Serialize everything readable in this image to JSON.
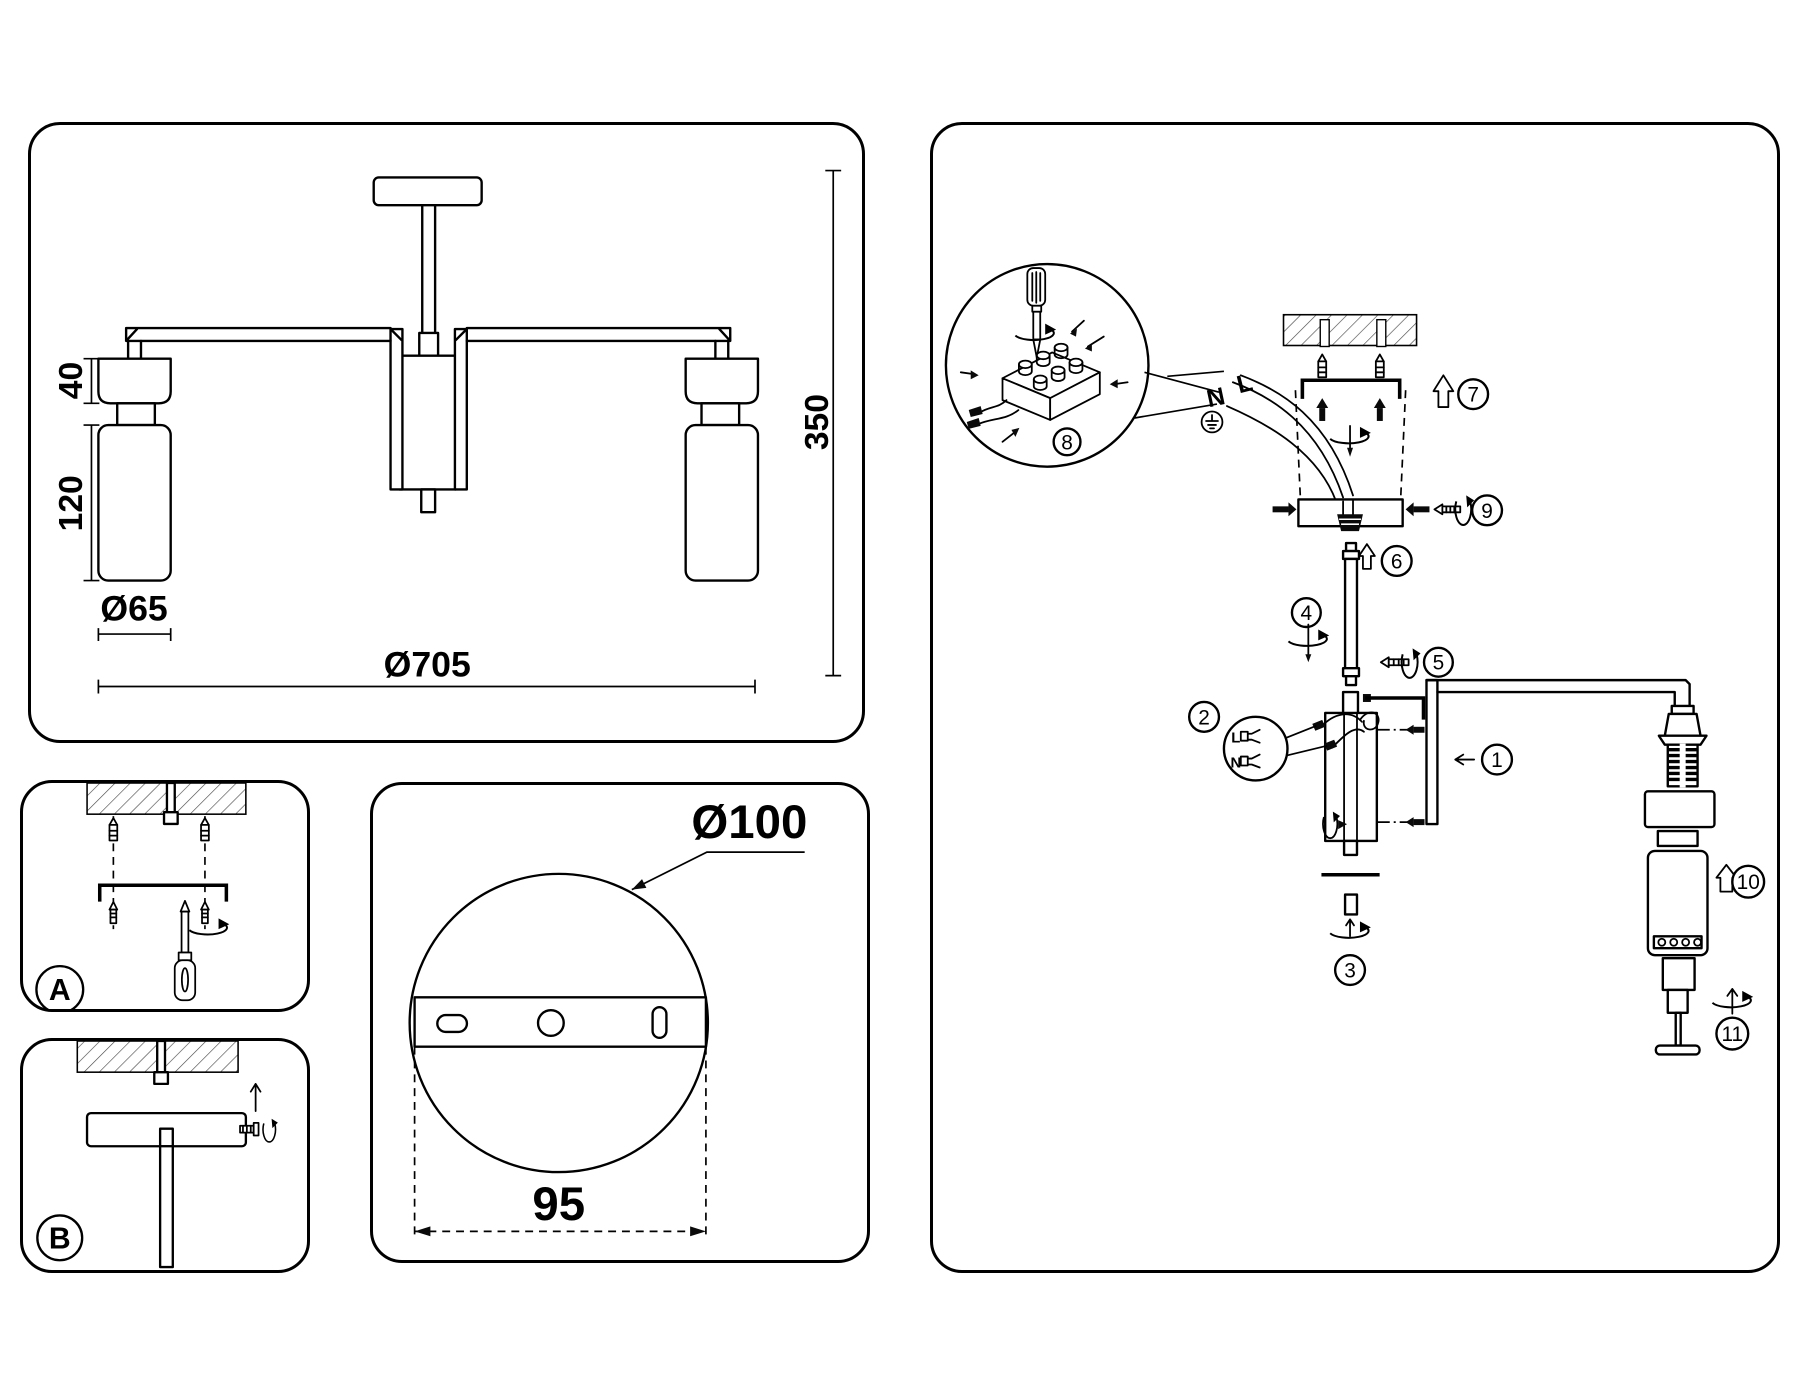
{
  "page": {
    "title": "Ceiling chandelier installation and dimensions diagram"
  },
  "colors": {
    "line": "#000000",
    "background": "#ffffff"
  },
  "dimension_panel": {
    "head_height": "40",
    "shade_height": "120",
    "shade_diameter": "Ø65",
    "fixture_diameter": "Ø705",
    "fixture_height": "350"
  },
  "step_a_panel": {
    "badge": "A"
  },
  "step_b_panel": {
    "badge": "B"
  },
  "canopy_panel": {
    "canopy_diameter": "Ø100",
    "hole_spacing": "95"
  },
  "assembly_panel": {
    "wire_live": "L",
    "wire_neutral": "N",
    "detail_wire_live": "L",
    "detail_wire_neutral": "N",
    "steps": [
      "1",
      "2",
      "3",
      "4",
      "5",
      "6",
      "7",
      "8",
      "9",
      "10",
      "11"
    ]
  }
}
